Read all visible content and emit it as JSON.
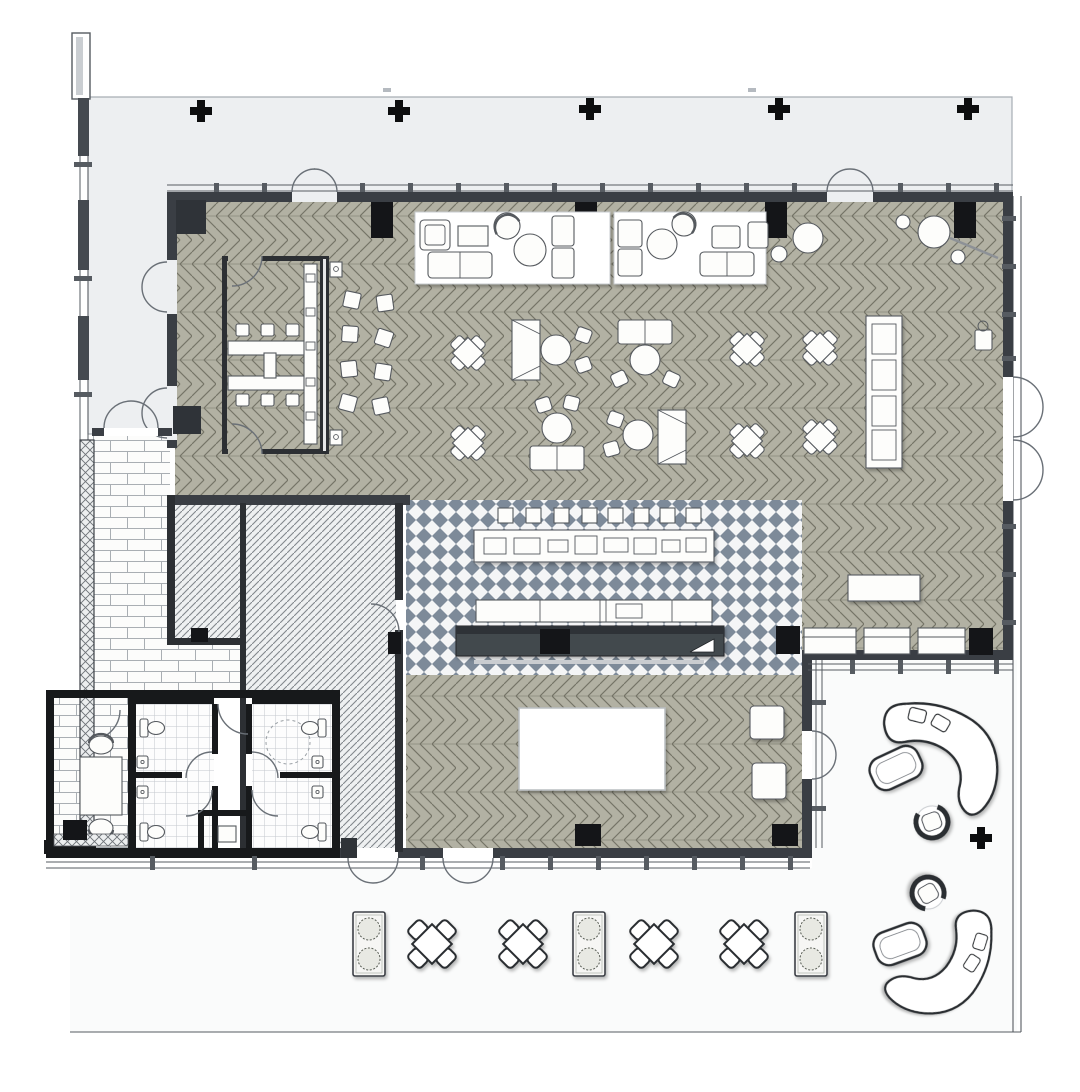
{
  "document": {
    "title": "Restaurant and lounge floor plan",
    "type": "architectural plan, top-down rendered, no text labels visible",
    "sheet_background": "#ffffff"
  },
  "palette": {
    "wall": "#3a3e44",
    "wall-mid": "#2c2f33",
    "wall-dark": "#17191b",
    "column": "#141518",
    "frame": "#565b61",
    "door": "#6a7077",
    "floor-wood": "#b2b1a3",
    "floor-line": "#757467",
    "checker-bg": "#f4f5f6",
    "checker-fg": "#7d8a99",
    "hatch-bg": "#eef0f1",
    "hatch-line": "#82878d",
    "tile-line": "#c3c8cd",
    "brick-line": "#a9aeb3",
    "court": "#edeff1",
    "court-line": "#a7adb3",
    "terrace": "#fafbfb",
    "furn-fill": "#fdfdfb",
    "furn-stroke": "#55595e",
    "bar-dark": "#43484e",
    "bar-darker": "#2e3237",
    "rug": "#ffffff",
    "outdoor-stroke": "#2a2d30"
  },
  "areas": [
    {
      "name": "main-dining-hall",
      "floor": "herringbone wood, taupe"
    },
    {
      "name": "meeting-room",
      "floor": "herringbone wood, glazed partition"
    },
    {
      "name": "bar-servery",
      "floor": "slate diamond checkerboard tile"
    },
    {
      "name": "kitchen-back-of-house",
      "floor": "diagonal hatch, two rooms"
    },
    {
      "name": "restroom-block",
      "floor": "small mosaic tile"
    },
    {
      "name": "entry-vestibule",
      "floor": "brick paving"
    },
    {
      "name": "waiting-room",
      "floor": "brick paving"
    },
    {
      "name": "courtyard-strip-north",
      "floor": "plain paving, light gray"
    },
    {
      "name": "outdoor-terrace-south",
      "floor": "plain paving, white"
    },
    {
      "name": "outdoor-lounge-east",
      "floor": "plain paving, white"
    }
  ],
  "furniture_inventory": {
    "lounge_rug_groups": 2,
    "indoor_x_dining_sets": 6,
    "indoor_mixed_table_groups": 4,
    "scatter_stools_by_meeting_room": 8,
    "meeting_table": 1,
    "meeting_chairs": 6,
    "meeting_credenza": 1,
    "bar_back_squares": 8,
    "bar_back_counter": 1,
    "bar_mid_counter": 1,
    "bar_front_counter_dark": 1,
    "buffet_display_counter": 1,
    "host_stand": 1,
    "high_round_tables": 2,
    "banquette_benches": 3,
    "banquette_table": 1,
    "stage_platform": 1,
    "square_side_tables": 2,
    "toilets": 4,
    "sinks": 5,
    "waiting_table_with_chairs": 1,
    "outdoor_planters": 3,
    "outdoor_x_dining_sets": 4,
    "curved_boomerang_benches": 2,
    "swivel_chairs": 2,
    "ottomans": 2,
    "interior_columns_black": 9,
    "interior_columns_gray": 2,
    "site_column_markers": 6,
    "exterior_double_doors": 8
  },
  "symbols": [
    "x-dining-set-icon",
    "planter-icon",
    "curved-bench-icon",
    "swivel-chair-icon",
    "ottoman-icon",
    "toilet-icon",
    "sink-icon",
    "double-door-icon",
    "column-marker-icon",
    "sofa-icon",
    "round-table-icon",
    "buffet-icon"
  ]
}
